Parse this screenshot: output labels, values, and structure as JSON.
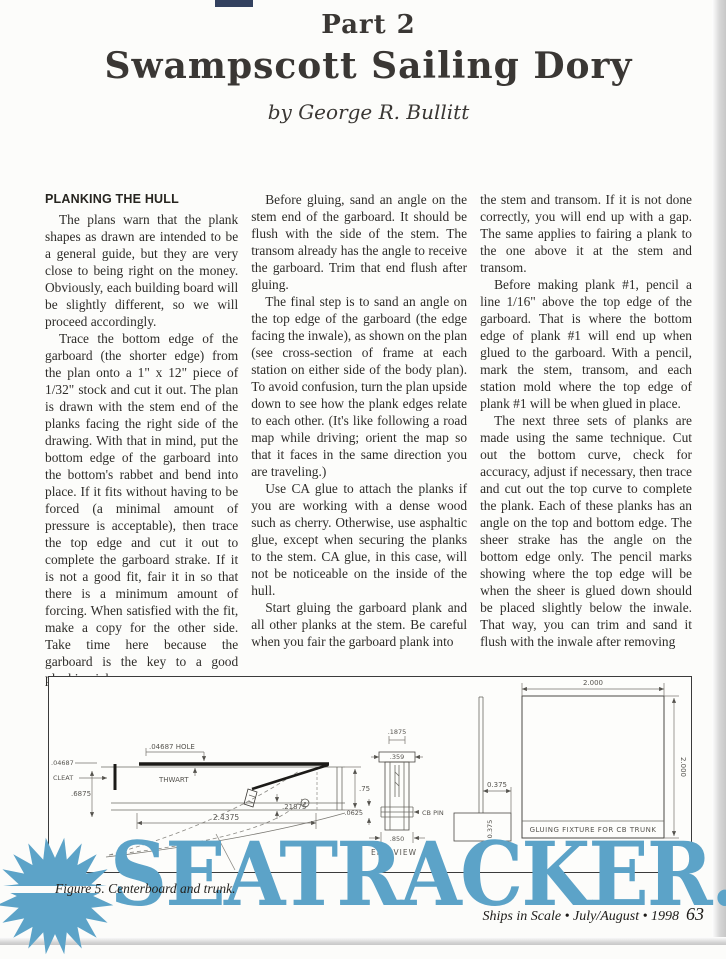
{
  "page": {
    "part_label": "Part 2",
    "title": "Swampscott Sailing Dory",
    "byline": "by George R. Bullitt"
  },
  "article": {
    "columns": [
      {
        "heading": "PLANKING THE HULL",
        "paragraphs": [
          {
            "text": "The plans warn that the plank shapes as drawn are intended to be a general guide, but they are very close to being right on the money. Obviously, each building board will be slightly different, so we will proceed accordingly."
          },
          {
            "text": "Trace the bottom edge of the garboard (the shorter edge) from the plan onto a 1\" x 12\" piece of 1/32\" stock and cut it out. The plan is drawn with the stem end of the planks facing the right side of the drawing. With that in mind, put the bottom edge of the garboard into the bottom's rabbet and bend into place. If it fits without having to be forced (a minimal amount of pressure is acceptable), then trace the top edge and cut it out to complete the garboard strake. If it is not a good fit, fair it in so that there is a minimum amount of forcing. When satisfied with the fit, make a copy for the other side. Take time here because the garboard is the key to a good planking job."
          }
        ]
      },
      {
        "paragraphs": [
          {
            "text": "Before gluing, sand an angle on the stem end of the garboard. It should be flush with the side of the stem. The transom already has the angle to receive the garboard. Trim that end flush after gluing."
          },
          {
            "text": "The final step is to sand an angle on the top edge of the garboard (the edge facing the inwale), as shown on the plan (see cross-section of frame at each station on either side of the body plan). To avoid confusion, turn the plan upside down to see how the plank edges relate to each other. (It's like following a road map while driving; orient the map so that it faces in the same direction you are traveling.)"
          },
          {
            "text": "Use CA glue to attach the planks if you are working with a dense wood such as cherry. Otherwise, use asphaltic glue, except when securing the planks to the stem. CA glue, in this case, will not be noticeable on the inside of the hull."
          },
          {
            "text": "Start gluing the garboard plank and all other planks at the stem. Be careful when you fair the garboard plank into"
          }
        ]
      },
      {
        "paragraphs": [
          {
            "text": "the stem and transom. If it is not done correctly, you will end up with a gap. The same applies to fairing a plank to the one above it at the stem and transom."
          },
          {
            "text": "Before making plank #1, pencil a line 1/16\" above the top edge of the garboard. That is where the bottom edge of plank #1 will end up when glued to the garboard. With a pencil, mark the stem, transom, and each station mold where the top edge of plank #1 will be when glued in place."
          },
          {
            "text": "The next three sets of planks are made using the same technique. Cut out the bottom curve, check for accuracy, adjust if necessary, then trace and cut out the top curve to complete the plank. Each of these planks has an angle on the top and bottom edge. The sheer strake has the angle on the bottom edge only. The pencil marks showing where the top edge will be when the sheer is glued down should be placed slightly below the inwale. That way, you can trim and sand it flush with the inwale after removing"
          }
        ]
      }
    ]
  },
  "figure": {
    "caption": "Figure 5. Centerboard and trunk.",
    "labels": {
      "hole_dim": ".04687 HOLE",
      "left_thickness": ".04687",
      "cleat": "CLEAT",
      "depth": ".6875",
      "thwart": "THWART",
      "height_right": ".75",
      "bottom_thickness": ".21875",
      "length": "2.4375",
      "end_slot": ".1875",
      "end_cap": ".359",
      "end_pin_offset": ".0625",
      "cb_pin": "CB PIN",
      "end_width": ".850",
      "end_view": "END VIEW",
      "board_offset": "0.375",
      "base_height": "0.375",
      "fixture_width": "2.000",
      "fixture_height": "2.000",
      "fixture_label": "GLUING FIXTURE FOR CB TRUNK"
    }
  },
  "footer": {
    "journal_line": "Ships in Scale • July/August • 1998",
    "page_number": "63"
  },
  "watermark": {
    "text": "SEATRACKER.RU",
    "color": "#5ca3c8"
  }
}
